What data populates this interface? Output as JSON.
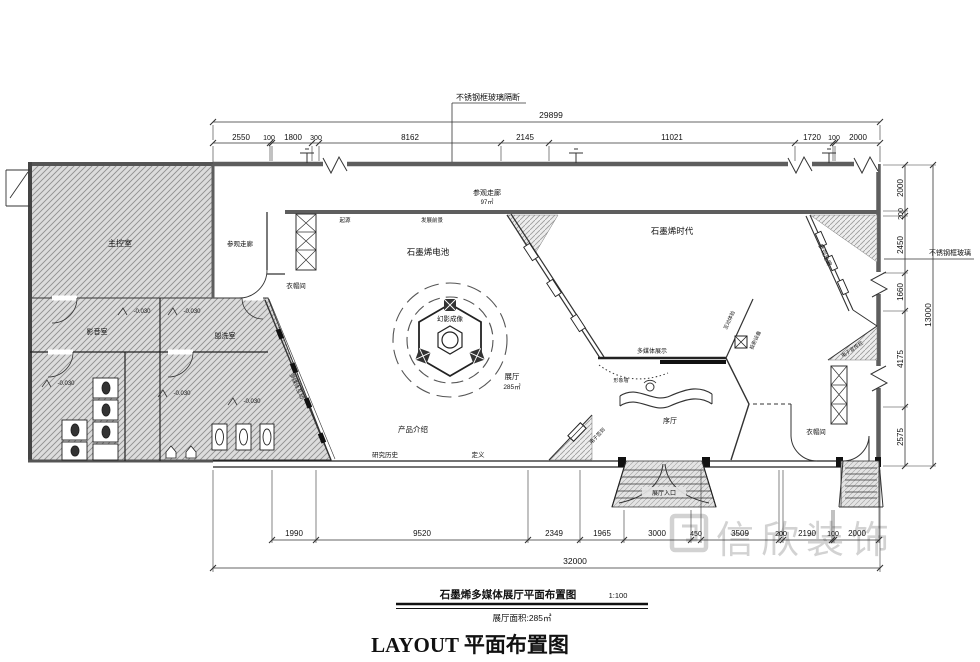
{
  "title_block": {
    "drawing_title": "石墨烯多媒体展厅平面布置图",
    "scale": "1:100",
    "area_note": "展厅面积:285㎡",
    "main_title": "LAYOUT  平面布置图"
  },
  "watermark": {
    "text": "信欣装饰"
  },
  "annotations": {
    "top_partition": "不锈钢框玻璃隔断",
    "right_partition": "不锈钢框玻璃"
  },
  "colors": {
    "line": "#333333",
    "wall": "#5e5e5e",
    "hatch": "#8f8f8f",
    "watermark": "#cbcbcb"
  },
  "rooms": {
    "main_control": "主控室",
    "corridor_left": "参观走廊",
    "corridor_top": "参观走廊",
    "corridor_top_area": "97㎡",
    "corridor_right": "参观走廊",
    "cloakroom_left": "衣帽间",
    "cloakroom_right": "衣帽间",
    "av_room": "影音室",
    "washroom": "盥洗室",
    "battery_zone": "石墨烯电池",
    "era_zone": "石墨烯时代",
    "hologram": "幻影成像",
    "hall": "展厅",
    "hall_area": "285㎡",
    "product_intro": "产品介绍",
    "research_history": "研究历史",
    "definition": "定义",
    "multimedia_display": "多媒体展示",
    "image_wall": "形象墙",
    "prelude_hall": "序厅",
    "entrance": "展厅入口",
    "origin": "起源",
    "prospects": "发展前景",
    "interactive": "多媒体互动",
    "e_checkin": "电子签到",
    "projection_device": "投影设备",
    "interactive_exp": "互动体验",
    "e_board": "电子宣传栏",
    "elevation": "-0.030"
  },
  "dims": {
    "top": {
      "total": "29899",
      "segments": [
        "2550",
        "100",
        "1800",
        "300",
        "8162",
        "2145",
        "11021",
        "1720",
        "100",
        "2000"
      ]
    },
    "right": {
      "total": "13000",
      "segments": [
        "2000",
        "200",
        "2450",
        "1660",
        "4175",
        "2575"
      ]
    },
    "bottom": {
      "total": "32000",
      "segments": [
        "1990",
        "9520",
        "2349",
        "1965",
        "3000",
        "450",
        "3509",
        "200",
        "2190",
        "100",
        "2000"
      ]
    }
  }
}
